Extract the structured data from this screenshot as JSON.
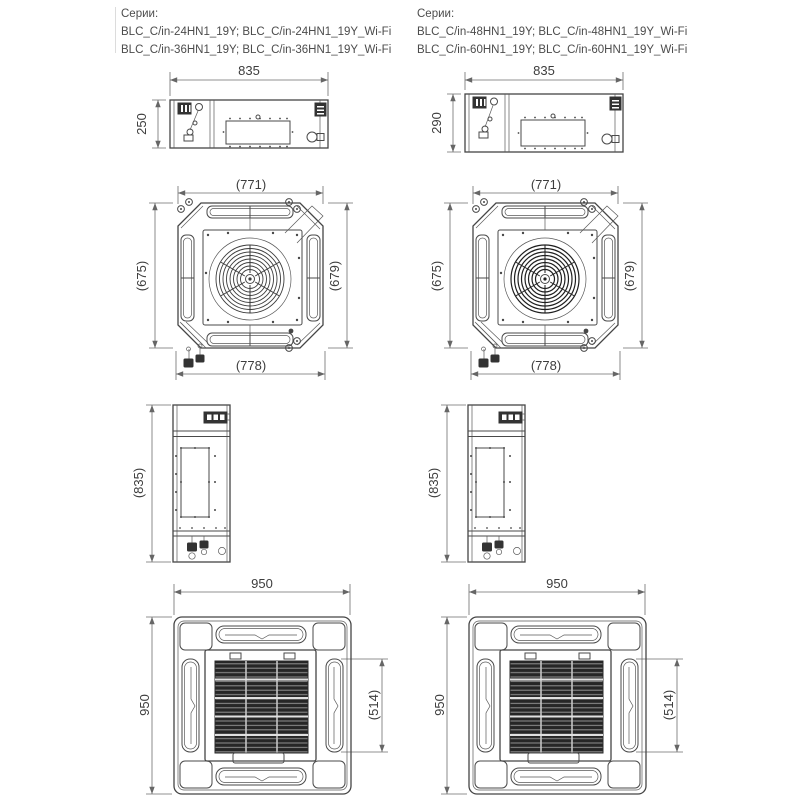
{
  "columns": [
    {
      "series_label": "Серии:",
      "series_lines": [
        "BLC_C/in-24HN1_19Y; BLC_C/in-24HN1_19Y_Wi-Fi",
        "BLC_C/in-36HN1_19Y; BLC_C/in-36HN1_19Y_Wi-Fi"
      ],
      "dims": {
        "body_width": "835",
        "body_height": "250",
        "chassis_top": "(771)",
        "chassis_left": "(675)",
        "chassis_right": "(679)",
        "chassis_bottom": "(778)",
        "profile_height": "(835)",
        "panel_width": "950",
        "panel_height": "950",
        "grille_height": "(514)"
      }
    },
    {
      "series_label": "Серии:",
      "series_lines": [
        "BLC_C/in-48HN1_19Y; BLC_C/in-48HN1_19Y_Wi-Fi",
        "BLC_C/in-60HN1_19Y; BLC_C/in-60HN1_19Y_Wi-Fi"
      ],
      "dims": {
        "body_width": "835",
        "body_height": "290",
        "chassis_top": "(771)",
        "chassis_left": "(675)",
        "chassis_right": "(679)",
        "chassis_bottom": "(778)",
        "profile_height": "(835)",
        "panel_width": "950",
        "panel_height": "950",
        "grille_height": "(514)"
      }
    }
  ],
  "colors": {
    "line": "#4a4a4a",
    "dimension_line": "#6e6e6e",
    "text": "#3d3d3d",
    "grille_dark": "#262626",
    "background": "#ffffff"
  }
}
